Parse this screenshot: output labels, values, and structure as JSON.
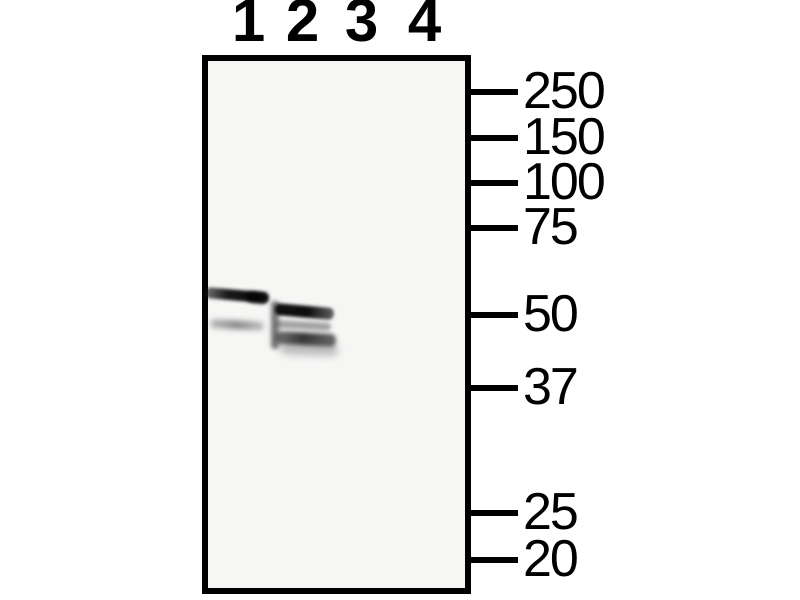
{
  "figure": {
    "kind": "western-blot",
    "panel_bg": "#f6f6f5",
    "ink": "#000000",
    "lane_labels": [
      {
        "label": "1",
        "x": 248
      },
      {
        "label": "2",
        "x": 302
      },
      {
        "label": "3",
        "x": 361
      },
      {
        "label": "4",
        "x": 424
      }
    ],
    "mw_markers": [
      {
        "label": "250",
        "y": 92
      },
      {
        "label": "150",
        "y": 138
      },
      {
        "label": "100",
        "y": 183
      },
      {
        "label": "75",
        "y": 228
      },
      {
        "label": "50",
        "y": 315
      },
      {
        "label": "37",
        "y": 388
      },
      {
        "label": "25",
        "y": 513
      },
      {
        "label": "20",
        "y": 560
      }
    ],
    "bands": [
      {
        "lane": "1",
        "x": 205,
        "y": 287,
        "w": 64,
        "h": 11,
        "tilt": 5,
        "blur": 1.7,
        "r": 5,
        "bg": "linear-gradient(90deg, rgba(25,25,25,0.6) 0%, rgba(8,8,8,0.92) 35%, rgba(0,0,0,0.95) 80%, rgba(15,15,15,0.85) 100%)"
      },
      {
        "lane": "1",
        "x": 247,
        "y": 291,
        "w": 21,
        "h": 11,
        "tilt": 6,
        "blur": 2,
        "r": 5,
        "bg": "rgba(0,0,0,0.7)"
      },
      {
        "lane": "1",
        "x": 210,
        "y": 319,
        "w": 54,
        "h": 9,
        "tilt": 3,
        "blur": 2.6,
        "r": 4,
        "bg": "linear-gradient(90deg, rgba(80,80,80,0.35), rgba(50,50,50,0.55) 50%, rgba(80,80,80,0.33))"
      },
      {
        "lane": "2",
        "x": 271,
        "y": 301,
        "w": 8,
        "h": 48,
        "tilt": 0,
        "blur": 2.2,
        "r": 3,
        "bg": "rgba(35,35,35,0.6)"
      },
      {
        "lane": "2",
        "x": 275,
        "y": 303,
        "w": 59,
        "h": 12,
        "tilt": 5,
        "blur": 1.7,
        "r": 5,
        "bg": "linear-gradient(90deg, rgba(5,5,5,0.95), rgba(0,0,0,0.95) 55%, rgba(40,40,40,0.72))"
      },
      {
        "lane": "2",
        "x": 276,
        "y": 320,
        "w": 55,
        "h": 8,
        "tilt": 3,
        "blur": 2.2,
        "r": 4,
        "bg": "rgba(75,75,75,0.5)"
      },
      {
        "lane": "2",
        "x": 276,
        "y": 331,
        "w": 60,
        "h": 13,
        "tilt": 3,
        "blur": 2.2,
        "r": 5,
        "bg": "linear-gradient(90deg, rgba(45,45,45,0.65), rgba(18,18,18,0.85) 45%, rgba(40,40,40,0.68))"
      },
      {
        "lane": "2",
        "x": 280,
        "y": 342,
        "w": 58,
        "h": 12,
        "tilt": 2,
        "blur": 4,
        "r": 6,
        "bg": "rgba(95,95,95,0.4)"
      }
    ]
  }
}
